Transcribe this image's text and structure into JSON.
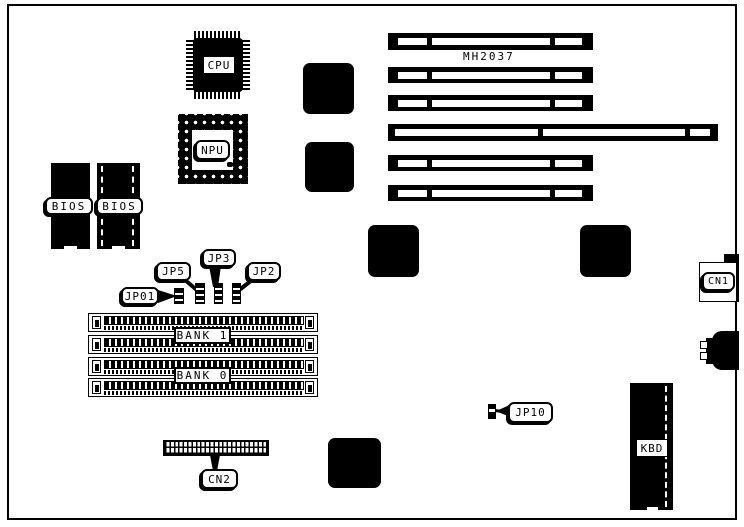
{
  "board": {
    "model": "MH2037",
    "labels": {
      "cpu": "CPU",
      "npu": "NPU",
      "bios_left": "BIOS",
      "bios_right": "BIOS",
      "jp01": "JP01",
      "jp5": "JP5",
      "jp3": "JP3",
      "jp2": "JP2",
      "jp10": "JP10",
      "bank1": "BANK 1",
      "bank0": "BANK 0",
      "cn1": "CN1",
      "cn2": "CN2",
      "kbd": "KBD"
    },
    "colors": {
      "ink": "#000000",
      "paper": "#ffffff"
    }
  }
}
